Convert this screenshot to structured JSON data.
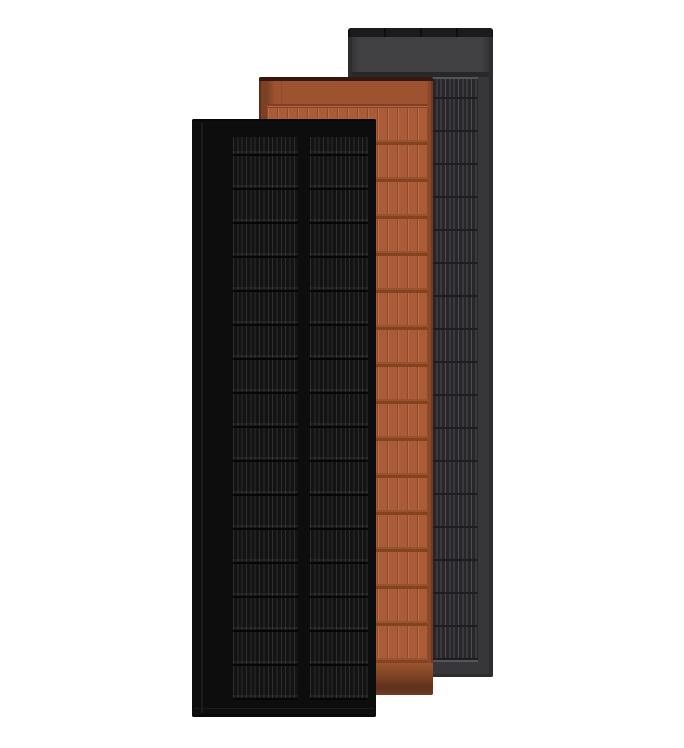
{
  "image": {
    "kind": "product-render",
    "subject": "Three vertical solar roof panels overlapping on a white background",
    "panels": [
      {
        "label": "Graphite gray solar panel",
        "position": "back",
        "finish": "graphite-gray",
        "base_color": "#37373a"
      },
      {
        "label": "Terracotta solar panel",
        "position": "middle",
        "finish": "terracotta",
        "base_color": "#a85a37"
      },
      {
        "label": "Matte black solar panel",
        "position": "front",
        "finish": "matte-black",
        "base_color": "#0d0d0d"
      }
    ]
  },
  "colors": {
    "bg": "#ffffff",
    "gray-body": "#37373a",
    "gray-topbar": "#1b1b1d",
    "gray-header": "#414144",
    "gray-header-edge": "#2e2e31",
    "gray-subband": "#28282b",
    "gray-lightline": "#54545a",
    "gray-grid-bg": "#27272a",
    "gray-grid-line": "#4d4d52",
    "gray-row-line": "#1d1d20",
    "gray-dark-edge": "#2d2d30",
    "terra-body": "#a85a37",
    "terra-top-line": "#35190f",
    "terra-header": "#9d5330",
    "terra-left-edge": "#7c4124",
    "terra-right-edge": "#8a4729",
    "terra-sep-dark": "#7f4023",
    "terra-sep-light": "#b7663f",
    "terra-grid-bg": "#aa5c39",
    "terra-groove-dark": "#8d4a2c",
    "terra-groove-light": "#bc6d45",
    "terra-row-dark": "#83431f",
    "terra-row-mid": "#995230",
    "terra-bottom-1": "#9b5430",
    "terra-bottom-2": "#7e4326",
    "terra-bottom-3": "#5d311c",
    "terra-bottom-4": "#6e3b23",
    "black-body": "#0d0d0d",
    "black-grid-bg": "#131313",
    "black-wire": "#2e2e2e",
    "black-row": "#060606",
    "black-seam": "#222222"
  }
}
